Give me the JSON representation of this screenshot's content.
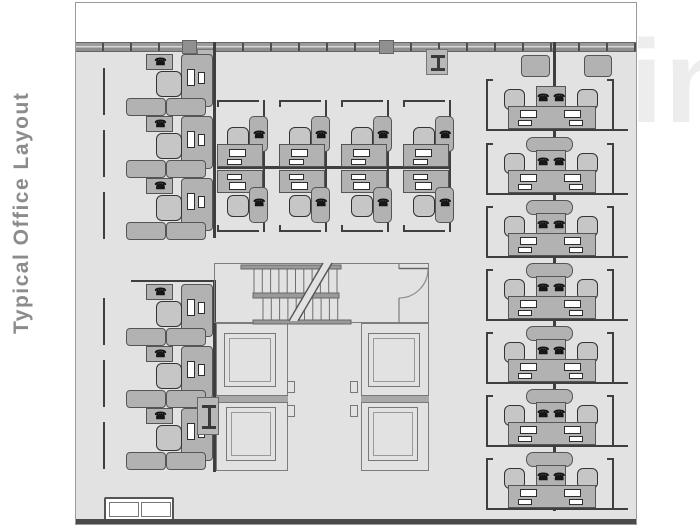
{
  "title": {
    "text": "Typical Office Layout"
  },
  "watermark": {
    "text": "in"
  },
  "icons": {
    "phone": "☎"
  },
  "colors": {
    "floor": "#e2e2e2",
    "exterior": "#ffffff",
    "band": "#9c9c9c",
    "band_tick": "#4f4f4f",
    "band_edge": "#666666",
    "panel": "#3f3f3f",
    "furniture": "#b2b2b2",
    "furniture_border": "#555555",
    "chair": "#c6c6c6",
    "chair_border": "#333333",
    "core_line": "#7d7d7d",
    "stair_line": "#6e6e6e",
    "stair_bar": "#9a9a9a",
    "mid_band": "#a8a8a8",
    "phone": "#141414",
    "column_fill": "#b8b8b8",
    "ibeam": "#3a3a3a",
    "bottom_wall": "#4a4a4a",
    "white": "#ffffff",
    "title": "#8c8c8c",
    "watermark": "#ededed"
  },
  "plan": {
    "exterior_strip": {
      "x": 0,
      "y": 0,
      "w": 560,
      "h": 39
    },
    "window_band": {
      "x": 0,
      "y": 39,
      "w": 560,
      "h": 10,
      "tick_every": 28
    },
    "band_columns": [
      {
        "x": 106,
        "w": 15
      },
      {
        "x": 303,
        "w": 15
      }
    ],
    "wall_columns": [
      {
        "x": 121,
        "y": 46,
        "w": 19,
        "h": 20,
        "ibeam": false
      },
      {
        "x": 350,
        "y": 46,
        "w": 22,
        "h": 26,
        "ibeam": true
      }
    ],
    "left_zone": {
      "unit_x": 27,
      "unit_ys": [
        51,
        113,
        175,
        281,
        343,
        405
      ],
      "group2_cap": {
        "x": 55,
        "y": 277,
        "w": 84
      },
      "spine_x": 137,
      "spine_segments": [
        [
          39,
          196
        ],
        [
          277,
          192
        ]
      ],
      "bottom_sofa": {
        "x": 28,
        "y": 494,
        "w": 70,
        "h": 24
      }
    },
    "center_block": {
      "unit_xs": [
        143,
        205,
        267,
        329
      ],
      "top_cap_y": 97,
      "bottom_cap_y": 227,
      "spine": {
        "x": 141,
        "y": 163,
        "w": 234
      }
    },
    "right_zone": {
      "spine_x": 477,
      "spine_y1": 39,
      "spine_y2": 508,
      "row_ts": [
        70,
        134,
        197,
        260,
        323,
        386,
        449
      ],
      "wall_cabinets": [
        {
          "x": 445,
          "y": 52,
          "w": 29,
          "h": 22
        },
        {
          "x": 508,
          "y": 52,
          "w": 28,
          "h": 22
        }
      ]
    },
    "core": {
      "outer_room": {
        "x": 138,
        "y": 260,
        "w": 215,
        "h": 60
      },
      "top_bar": {
        "x": 165,
        "y": 262,
        "w": 100,
        "h": 4
      },
      "flight1": {
        "x0": 178,
        "x1": 262,
        "step": 8.3,
        "y0": 265,
        "y1": 291
      },
      "landing_bar": {
        "x": 177,
        "y": 290,
        "w": 86,
        "h": 5
      },
      "flight2": {
        "x0": 187,
        "x1": 262,
        "step": 8.3,
        "y0": 294,
        "y1": 318
      },
      "bottom_bar": {
        "x": 177,
        "y": 317,
        "w": 98,
        "h": 4
      },
      "break_poly": [
        [
          213,
          318
        ],
        [
          247,
          260
        ],
        [
          256,
          260
        ],
        [
          222,
          318
        ]
      ],
      "door": {
        "wall_x": 323,
        "gap_y1": 266,
        "gap_y2": 295,
        "leaf": [
          323,
          265.5,
          352,
          265.5
        ],
        "arc": "M 352 266 A 29 29 0 0 1 323 295"
      },
      "towers": [
        {
          "x": 140,
          "y": 320,
          "w": 72,
          "h": 148,
          "band_y": 392,
          "notch_x": 211,
          "cars": [
            {
              "x": 148,
              "y": 330,
              "w": 52,
              "h": 54
            },
            {
              "x": 150,
              "y": 404,
              "w": 50,
              "h": 54
            }
          ]
        },
        {
          "x": 285,
          "y": 320,
          "w": 68,
          "h": 148,
          "band_y": 392,
          "notch_x": 274,
          "cars": [
            {
              "x": 292,
              "y": 330,
              "w": 52,
              "h": 54
            },
            {
              "x": 292,
              "y": 404,
              "w": 50,
              "h": 54
            }
          ]
        }
      ],
      "ibeam_box": {
        "x": 121,
        "y": 394,
        "w": 22,
        "h": 38
      }
    },
    "bottom_wall": {
      "x": 0,
      "y": 516,
      "w": 560,
      "h": 5
    }
  }
}
